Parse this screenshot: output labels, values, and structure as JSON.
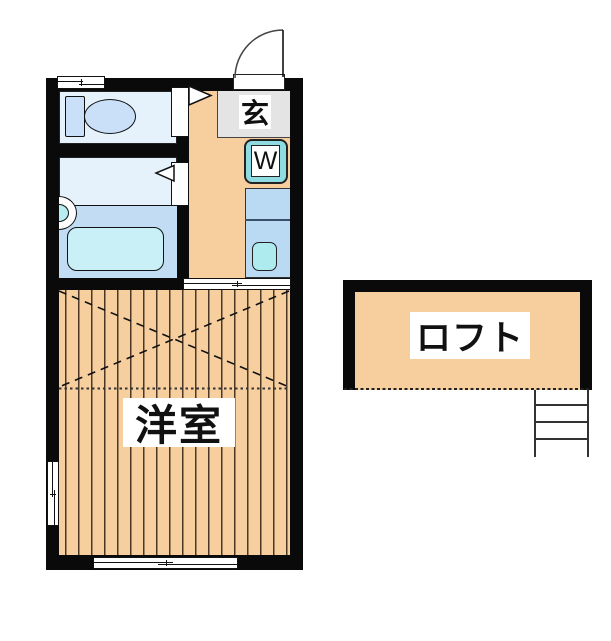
{
  "meta": {
    "type": "japanese-apartment-floor-plan"
  },
  "labels": {
    "entrance": "玄",
    "washing_machine": "W",
    "western_room": "洋室",
    "loft": "ロフト"
  },
  "fixtures": [
    "toilet",
    "bathtub",
    "washbasin",
    "kitchen-sink",
    "washing-machine-slot",
    "entrance-door",
    "loft-ladder"
  ],
  "colors": {
    "wall": "#0a0a0a",
    "wood_floor": "#f7cf9f",
    "wet_room": "#e5f2fc",
    "wet_room_band": "#c2ddf3",
    "bathtub": "#c9f0f6",
    "fixture_blue": "#c9e0f8",
    "kitchen_counter": "#badaf3",
    "kitchen_sink": "#aeebee",
    "washer_box": "#8edce2",
    "entrance_floor": "#e4e4e4"
  }
}
